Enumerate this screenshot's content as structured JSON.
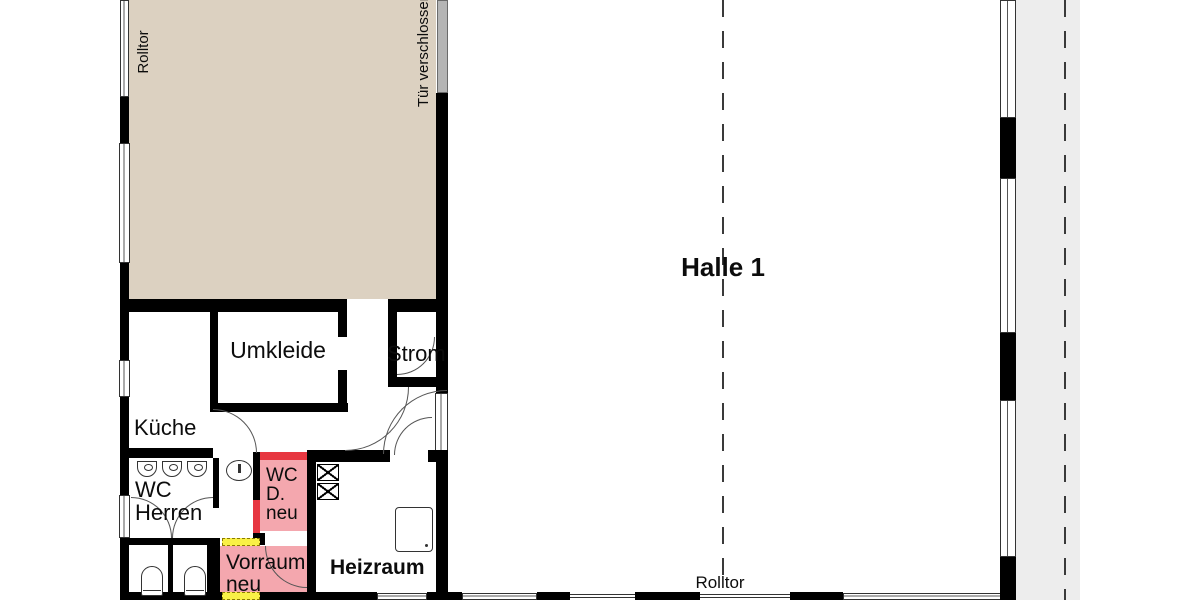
{
  "title": "Floor plan – Halle 1",
  "labels": {
    "halle": "Halle 1",
    "umkleide": "Umkleide",
    "strom": "Strom",
    "kueche": "Küche",
    "wc_herren_1": "WC",
    "wc_herren_2": "Herren",
    "wc_d_1": "WC",
    "wc_d_2": "D.",
    "wc_d_3": "neu",
    "vorraum_1": "Vorraum",
    "vorraum_2": "neu",
    "heizraum": "Heizraum",
    "rolltor_left": "Rolltor",
    "rolltor_bottom": "Rolltor",
    "tuer_verschlossen": "Tür verschlossen"
  },
  "colors": {
    "wall": "#000000",
    "storage_room_fill": "#dcd1c1",
    "highlight_room_fill": "#f4a7ae",
    "highlight_wall": "#e73741",
    "door_marker": "#f9f046",
    "exterior_strip": "#ededed",
    "locked_door": "#b5b5b5"
  }
}
